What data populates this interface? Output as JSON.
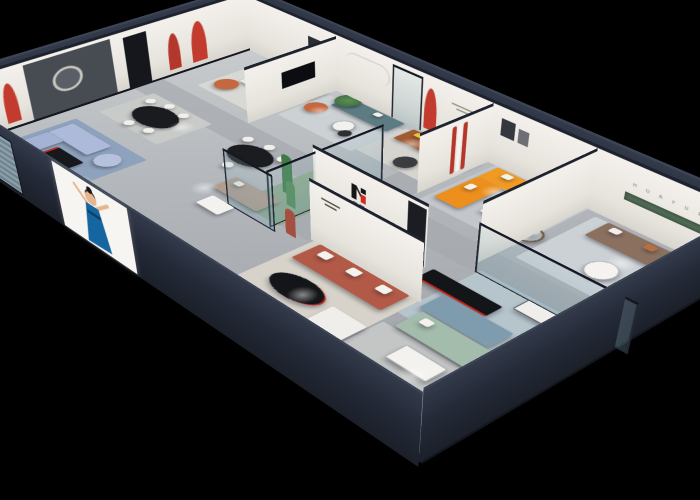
{
  "scene": {
    "kind": "3d-isometric-cutaway-render",
    "subject": "furniture showroom floor plan dollhouse view",
    "background_color": "#000000",
    "wall_exterior_color": "#242a38",
    "wall_interior_color": "#ece9e4",
    "floor_color": "#b7babd"
  },
  "brand": {
    "logo_text": "华悦",
    "logo_mark_colors": [
      "#151515",
      "#cf2a1d"
    ],
    "niche_letters": "H U A Y U E"
  },
  "facade": {
    "screen": {
      "description": "white poster screen with illustrated dancing woman",
      "woman_dress_color": "#1565a0",
      "background": "#f6f5f2"
    },
    "window": {
      "description": "slatted window near left corner",
      "color": "#9fb6c0"
    }
  },
  "rooms": [
    {
      "name": "office-reception",
      "furniture": [
        "white-sofa",
        "white-coffee-table",
        "orange-armchair"
      ],
      "accent": "#c4683f"
    },
    {
      "name": "teal-living-display",
      "furniture": [
        "teal-sofa",
        "orange-armchair",
        "potted-tree",
        "round-tables"
      ],
      "accent": "#5d7b82"
    },
    {
      "name": "dining-display-left",
      "furniture": [
        "black-oval-table",
        "white-chairs"
      ],
      "accent": "#1a1b1e"
    },
    {
      "name": "periwinkle-living-display",
      "furniture": [
        "periwinkle-sofa",
        "black-coffee-table",
        "tv-console"
      ],
      "accent": "#adbad9"
    },
    {
      "name": "reception-dining",
      "furniture": [
        "black-oval-table",
        "white-chairs",
        "taupe-sofa"
      ],
      "accent": "#b29c8e"
    },
    {
      "name": "cognac-sofa-display",
      "furniture": [
        "cognac-sofa",
        "yellow-pillow",
        "round-side-table"
      ],
      "accent": "#a05b33"
    },
    {
      "name": "orange-sectional-display",
      "furniture": [
        "orange-l-sofa",
        "white-coffee-table",
        "runner-sculpture"
      ],
      "accent": "#f09a24"
    },
    {
      "name": "leather-sofa-display-right",
      "furniture": [
        "taupe-leather-sofa",
        "round-white-table",
        "green-niche-shelf"
      ],
      "accent": "#8b7060"
    },
    {
      "name": "mint-blue-display",
      "furniture": [
        "blue-sofa",
        "mint-sofa",
        "black-console",
        "display-table"
      ],
      "accent": "#a3bcac"
    },
    {
      "name": "white-sofa-front-room",
      "furniture": [
        "white-sofa",
        "coffee-table"
      ],
      "accent": "#e8e7e3"
    },
    {
      "name": "terracotta-display",
      "furniture": [
        "terracotta-sofa",
        "black-oval-coffee-table",
        "white-ottoman",
        "mannequin-statue"
      ],
      "accent": "#b25a47"
    },
    {
      "name": "glass-plant-box",
      "furniture": [
        "cactus-plants",
        "terracotta-mannequin"
      ],
      "accent": "#3f7a46"
    }
  ],
  "details": {
    "red_arch_niches_color": "#c23b2e",
    "green_niche_color": "#4f6a55",
    "rug_blue_color": "#8ea2bd",
    "slogan_lines_on_wall": 2,
    "spotlight_glow_color": "#ffffff"
  }
}
